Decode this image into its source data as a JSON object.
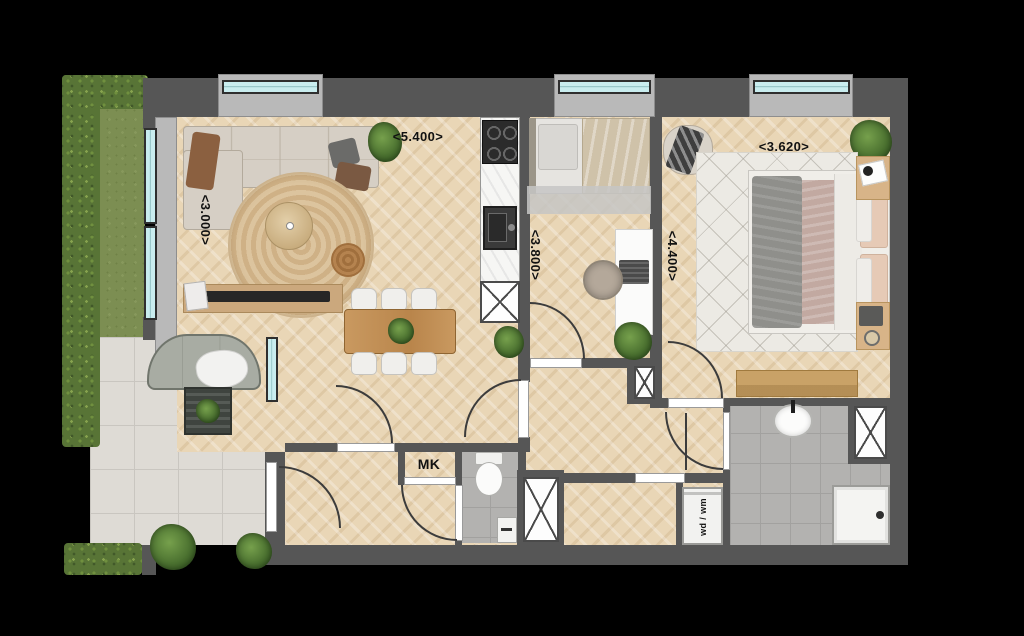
{
  "plan": {
    "type": "apartment-floorplan-top-view",
    "dimension_labels": {
      "living_width": "<5.400>",
      "living_depth": "<3.000>",
      "bedroom2_depth": "<3.800>",
      "bedroom1_depth": "<4.400>",
      "bedroom1_width": "<3.620>"
    },
    "room_labels": {
      "meter_cupboard": "MK",
      "washer_dryer": "wd / wm"
    },
    "colors": {
      "background": "#000000",
      "wall": "#565656",
      "window_recess": "#b9b9b9",
      "window_glass": "#c9edef",
      "wood_floor": "#e9d6b6",
      "bath_tile": "#b3b2b0",
      "terrace_tile": "#dedbd5",
      "grass": "#7c8e52",
      "hedge": "#587436"
    },
    "furniture_symbols": [
      "corner-sofa",
      "round-rug",
      "coffee-table",
      "pouf",
      "tv-console",
      "dining-table",
      "dining-chairs",
      "kitchen-counter",
      "cooktop",
      "kitchen-sink",
      "single-bed",
      "desk",
      "desk-chair",
      "double-bed",
      "nightstands",
      "armchair",
      "wardrobe-bench",
      "toilet",
      "washbasin",
      "shower-tray",
      "washing-machine",
      "outdoor-sofa",
      "outdoor-table",
      "potted-plants",
      "door-swing-arcs",
      "ventilation-shafts"
    ]
  }
}
